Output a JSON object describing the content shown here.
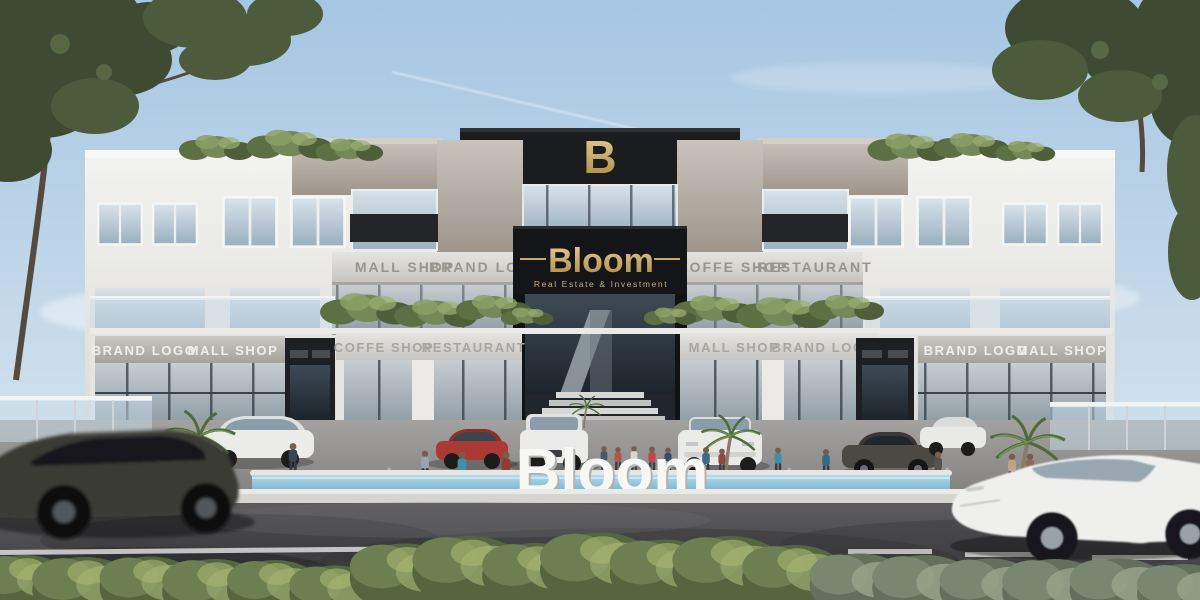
{
  "meta": {
    "type": "architectural-rendering",
    "subject": "Bloom Real Estate & Investment commercial mall exterior"
  },
  "branding": {
    "logo_letter": "B",
    "name": "Bloom",
    "tagline": "Real  Estate  &  Investment",
    "plaza_sign": "Bloom",
    "gold_color": "#c9a86c",
    "panel_color": "#17181a"
  },
  "signs": {
    "mid_left": [
      "MALL SHOP",
      "BRAND LOGO"
    ],
    "mid_right": [
      "COFFE SHOP",
      "RESTAURANT"
    ],
    "ground_far_left": [
      "BRAND LOGO",
      "MALL SHOP"
    ],
    "ground_left": [
      "COFFE SHOP",
      "RESTAURANT"
    ],
    "ground_right": [
      "MALL SHOP",
      "BRAND LOGO"
    ],
    "ground_far_right": [
      "BRAND LOGO",
      "MALL SHOP"
    ]
  },
  "palette": {
    "sky_top": "#a6c6e3",
    "sky_bottom": "#e7eef3",
    "facade": "#f0efed",
    "concrete": "#b1aba4",
    "glass": "#9fb2c0",
    "road": "#4c4c4e",
    "pool": "#9cc8e2",
    "foliage": "#57693f"
  }
}
